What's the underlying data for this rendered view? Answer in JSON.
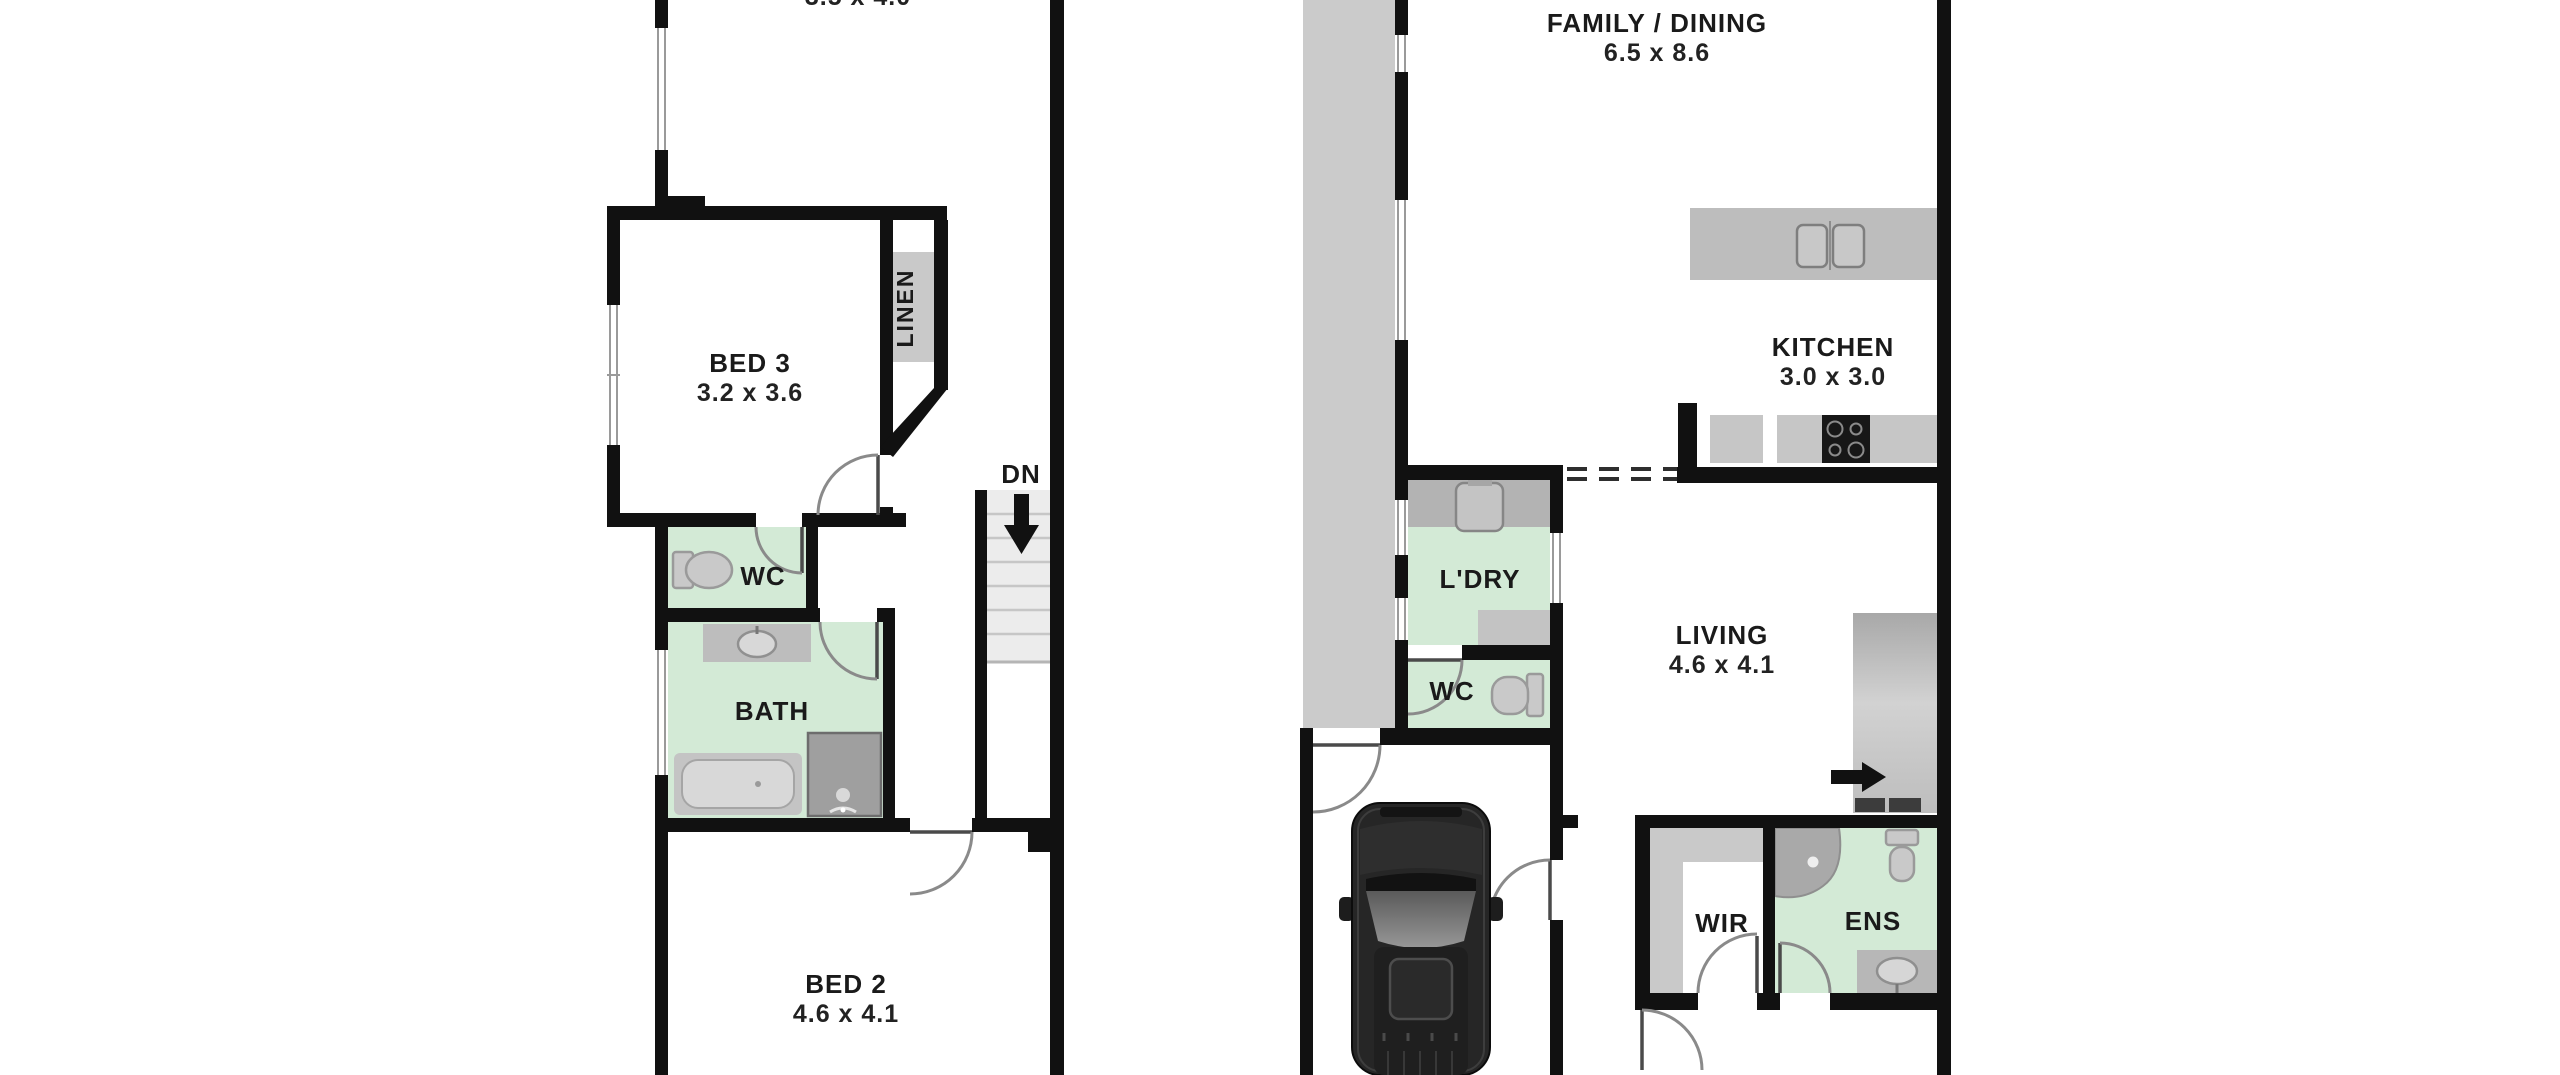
{
  "plan": {
    "left": {
      "upper_dims": "3.5 x 4.0",
      "bed3_name": "BED 3",
      "bed3_dims": "3.2 x 3.6",
      "linen": "LINEN",
      "stairs_dn": "DN",
      "wc": "WC",
      "bath": "BATH",
      "bed2_name": "BED 2",
      "bed2_dims": "4.6 x 4.1"
    },
    "right": {
      "family_name": "FAMILY / DINING",
      "family_dims": "6.5 x 8.6",
      "kitchen_name": "KITCHEN",
      "kitchen_dims": "3.0 x 3.0",
      "laundry": "L'DRY",
      "wc": "WC",
      "living_name": "LIVING",
      "living_dims": "4.6 x 4.1",
      "wir": "WIR",
      "ens": "ENS"
    }
  },
  "colors": {
    "wall": "#111111",
    "wet_area_green": "#d3ead6",
    "fixture_gray": "#c9c9c9",
    "bench_gray": "#bdbdbd",
    "stair_gray": "#ececec",
    "path_gray": "#cbcbcb",
    "car_body": "#262626",
    "label_text": "#1a1a1a",
    "background": "#ffffff"
  }
}
